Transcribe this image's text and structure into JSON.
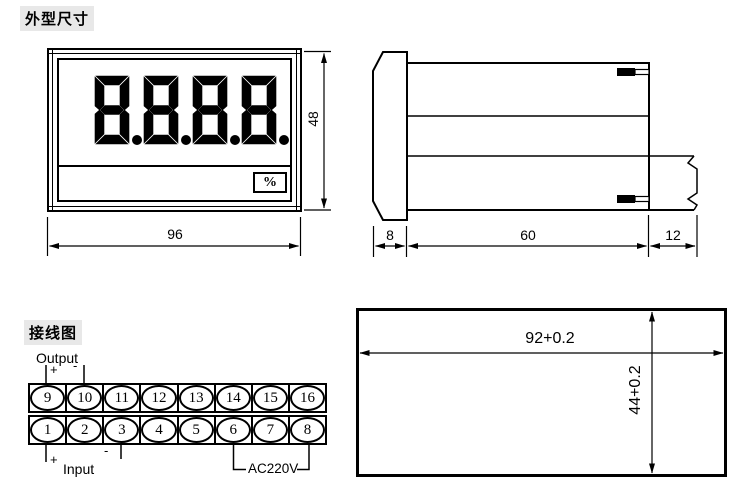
{
  "sections": {
    "outline": {
      "title": "外型尺寸",
      "front_view": {
        "display_value": "8.8.8.8.",
        "unit": "%",
        "dim_width": "96",
        "dim_height": "48"
      },
      "side_view": {
        "dim_bezel": "8",
        "dim_body": "60",
        "dim_terminal": "12"
      }
    },
    "wiring": {
      "title": "接线图",
      "output": {
        "label": "Output",
        "plus": "+",
        "minus": "-"
      },
      "input": {
        "label": "Input",
        "plus": "+",
        "minus": "-"
      },
      "power": {
        "label": "AC220V"
      },
      "terminals_top": [
        "9",
        "10",
        "11",
        "12",
        "13",
        "14",
        "15",
        "16"
      ],
      "terminals_bottom": [
        "1",
        "2",
        "3",
        "4",
        "5",
        "6",
        "7",
        "8"
      ]
    },
    "cutout": {
      "dim_width": "92+0.2",
      "dim_height": "44+0.2"
    }
  },
  "colors": {
    "line": "#000000",
    "background": "#ffffff",
    "title_bg": "#e8e8e8"
  }
}
